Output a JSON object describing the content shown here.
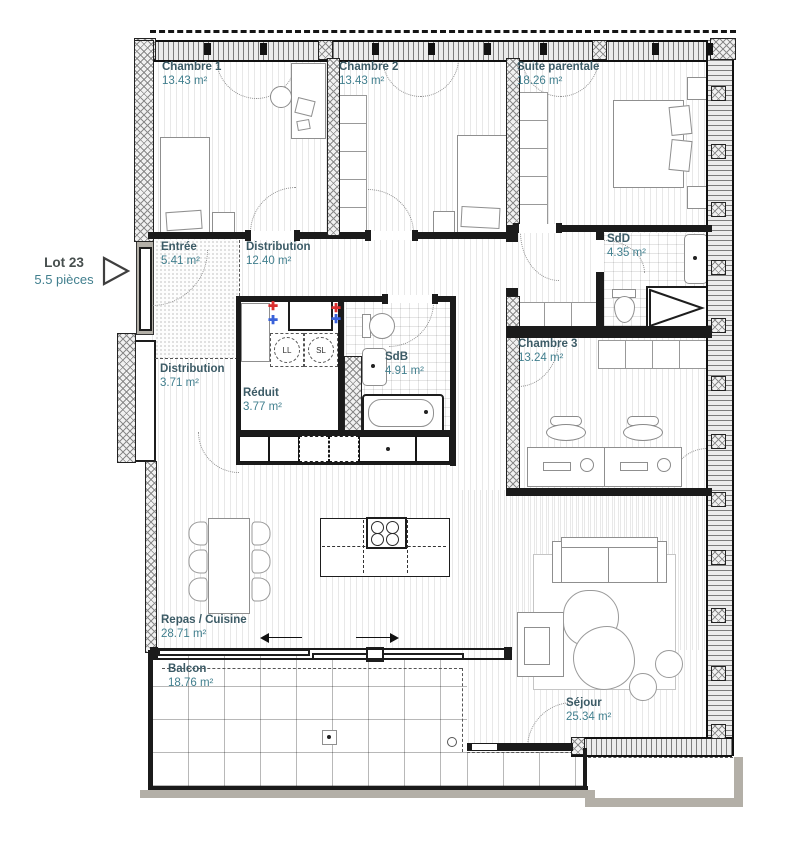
{
  "lot": {
    "number": "Lot 23",
    "size": "5.5 pièces"
  },
  "rooms": [
    {
      "id": "chambre1",
      "name": "Chambre 1",
      "area": "13.43 m²"
    },
    {
      "id": "chambre2",
      "name": "Chambre 2",
      "area": "13.43 m²"
    },
    {
      "id": "suite-parentale",
      "name": "Suite parentale",
      "area": "18.26 m²"
    },
    {
      "id": "sdd",
      "name": "SdD",
      "area": "4.35 m²"
    },
    {
      "id": "entree",
      "name": "Entrée",
      "area": "5.41 m²"
    },
    {
      "id": "distribution-1",
      "name": "Distribution",
      "area": "12.40 m²"
    },
    {
      "id": "distribution-2",
      "name": "Distribution",
      "area": "3.71 m²"
    },
    {
      "id": "reduit",
      "name": "Réduit",
      "area": "3.77 m²"
    },
    {
      "id": "sdb",
      "name": "SdB",
      "area": "4.91 m²"
    },
    {
      "id": "chambre3",
      "name": "Chambre 3",
      "area": "13.24 m²"
    },
    {
      "id": "repas-cuisine",
      "name": "Repas / Cuisine",
      "area": "28.71 m²"
    },
    {
      "id": "balcon",
      "name": "Balcon",
      "area": "18.76 m²"
    },
    {
      "id": "sejour",
      "name": "Séjour",
      "area": "25.34 m²"
    }
  ],
  "appliances": {
    "washer": "LL",
    "dryer": "SL"
  },
  "symbols": {
    "hot_water": "✚",
    "cold_water": "✚"
  },
  "colors": {
    "room_name": "#3c5b66",
    "room_area": "#417f8e",
    "lot_name": "#474f4e",
    "wall": "#1b1b1b",
    "hot_water": "#d93030",
    "cold_water": "#3a62d9"
  }
}
